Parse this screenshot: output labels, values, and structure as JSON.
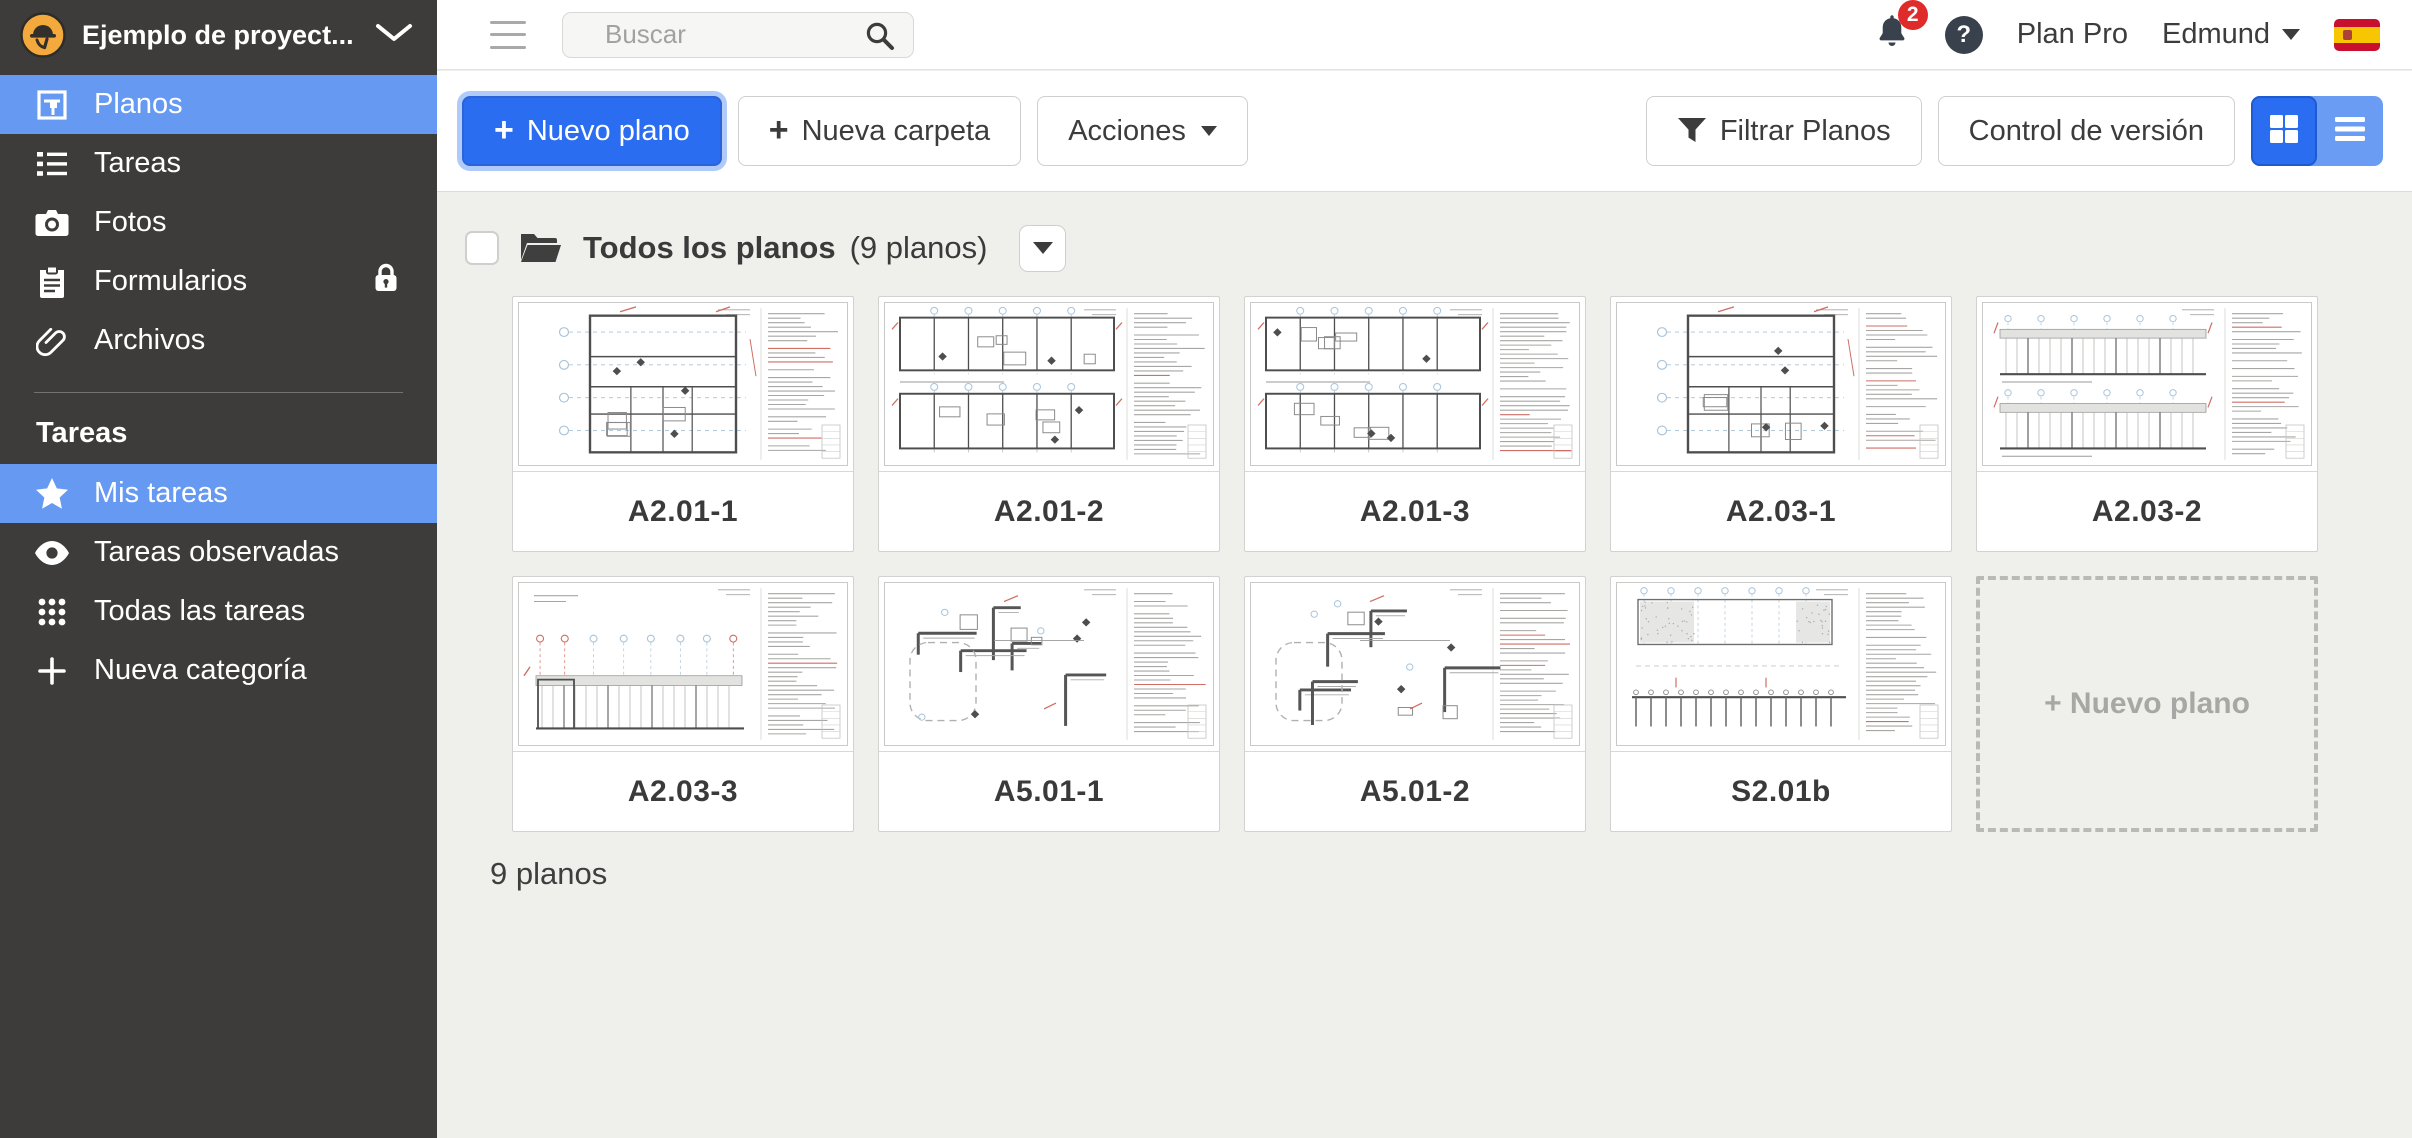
{
  "header": {
    "project_title": "Ejemplo de proyect...",
    "search_placeholder": "Buscar",
    "notification_count": "2",
    "help_label": "?",
    "plan_badge": "Plan Pro",
    "user_name": "Edmund"
  },
  "sidebar": {
    "main_items": [
      {
        "label": "Planos"
      },
      {
        "label": "Tareas"
      },
      {
        "label": "Fotos"
      },
      {
        "label": "Formularios"
      },
      {
        "label": "Archivos"
      }
    ],
    "section_title": "Tareas",
    "task_items": [
      {
        "label": "Mis tareas"
      },
      {
        "label": "Tareas observadas"
      },
      {
        "label": "Todas las tareas"
      },
      {
        "label": "Nueva categoría"
      }
    ]
  },
  "toolbar": {
    "plus": "+",
    "new_plan": "Nuevo plano",
    "new_folder": "Nueva carpeta",
    "actions": "Acciones",
    "filter_plans": "Filtrar Planos",
    "version_control": "Control de versión"
  },
  "content": {
    "folder_title": "Todos los planos",
    "folder_count": "(9 planos)",
    "plans": [
      {
        "code": "A2.01-1",
        "thumb": "plan_tall",
        "seed": 11
      },
      {
        "code": "A2.01-2",
        "thumb": "plan_two",
        "seed": 23
      },
      {
        "code": "A2.01-3",
        "thumb": "plan_two",
        "seed": 37
      },
      {
        "code": "A2.03-1",
        "thumb": "plan_tall",
        "seed": 49
      },
      {
        "code": "A2.03-2",
        "thumb": "elevation_two",
        "seed": 58
      },
      {
        "code": "A2.03-3",
        "thumb": "elevation_low",
        "seed": 67
      },
      {
        "code": "A5.01-1",
        "thumb": "detail",
        "seed": 76
      },
      {
        "code": "A5.01-2",
        "thumb": "detail",
        "seed": 91
      },
      {
        "code": "S2.01b",
        "thumb": "structural",
        "seed": 102
      }
    ],
    "new_plan_placeholder": "+ Nuevo plano",
    "footer_count": "9 planos"
  },
  "colors": {
    "accent_blue": "#2a6df0",
    "selection_blue": "#6699f2",
    "badge_red": "#e02b2b",
    "sidebar_bg": "#3d3c3a"
  }
}
